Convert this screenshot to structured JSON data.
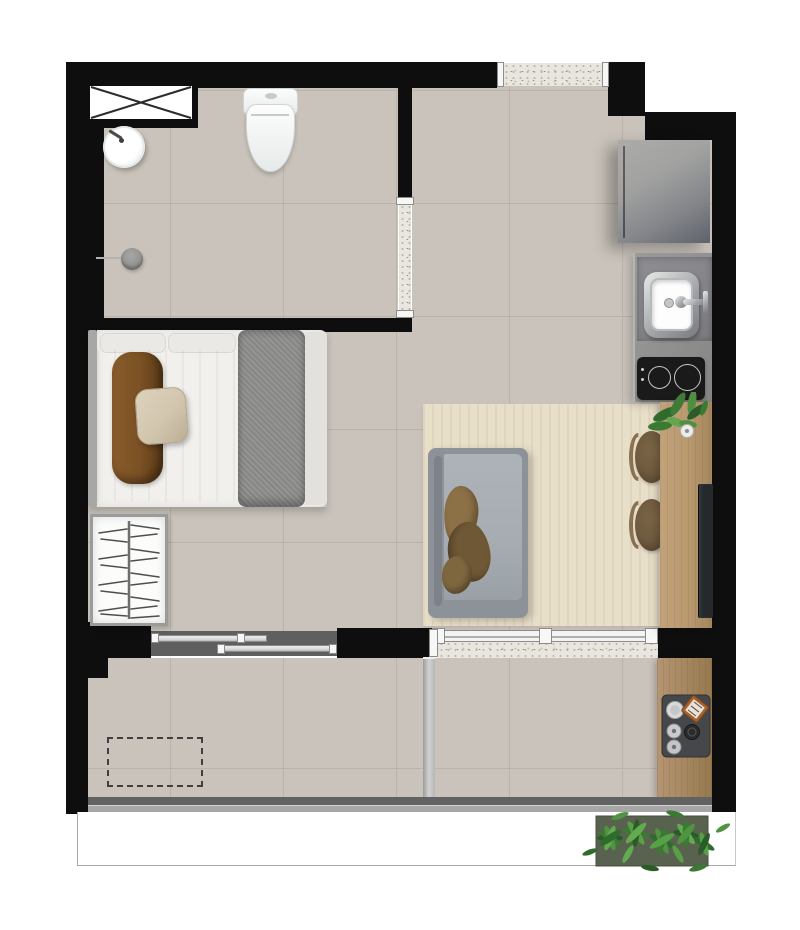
{
  "canvas": {
    "width": 800,
    "height": 930,
    "background": "#ffffff"
  },
  "scene": {
    "kind": "apartment-floor-plan",
    "style": "top-down rendered architectural plan, no text labels",
    "unit_type": "studio apartment with balcony"
  },
  "palette": {
    "white": "#ffffff",
    "wall": "#0e0e0e",
    "tile": "#c9c3bb",
    "grout": "#bab3aa",
    "granite": "#e9e6df",
    "rug": "#e8dfc9",
    "wood": "#b9986e",
    "woodDark": "#a5875f",
    "sofa": "#a6acb2",
    "sofaFrame": "#8c9297",
    "throw": "#8d7146",
    "throwDark": "#6f5835",
    "chair": "#6e5a3e",
    "chairBack": "#8a7152",
    "sheet": "#f1f0ed",
    "bedBlanket": "#8e8e8c",
    "headboard": "#a7a7a5",
    "pillowBrown": "#7a5124",
    "pillowBeige": "#d2c6af",
    "counter": "#90908e",
    "counterDark": "#85858a",
    "cooktop": "#1a1a1a",
    "fridgeA": "#a2a3a1",
    "fridgeB": "#5f626a",
    "tv": "#26292c",
    "glass": "#5f5f5f",
    "glassBar": "#dcdcdc",
    "plant": "#3f7a38",
    "planter": "#59624f",
    "parapetA": "#626262",
    "parapetB": "#a6a6a6",
    "partition": "#b5b5b5",
    "copper": "#a5622c"
  },
  "rooms": [
    {
      "id": "bathroom",
      "items": [
        "ventilation-shaft-x-box",
        "toilet",
        "round-washbasin",
        "wall-mounted-faucet",
        "shower-floor-drain",
        "granite-door-threshold"
      ]
    },
    {
      "id": "entry-kitchen",
      "items": [
        "granite-entry-threshold",
        "refrigerator",
        "concrete-counter",
        "square-undermount-sink",
        "kitchen-faucet",
        "two-burner-cooktop"
      ]
    },
    {
      "id": "studio-bedroom",
      "items": [
        "double-bed",
        "headboard",
        "white-pillows",
        "brown-bolster-pillow",
        "beige-accent-pillow",
        "gray-bed-runner",
        "open-wardrobe-with-hangers",
        "sliding-window-to-balcony"
      ]
    },
    {
      "id": "living-dining",
      "items": [
        "light-wood-rug",
        "gray-sofa",
        "brown-throw-blanket",
        "dining-console-table",
        "round-chair",
        "round-chair",
        "potted-plant",
        "wall-mounted-tv",
        "sliding-glass-door"
      ]
    },
    {
      "id": "balcony",
      "items": [
        "glass-partition",
        "dashed-future-furniture-outline",
        "wood-grill-counter",
        "barbecue-grill-set",
        "parapet-rail",
        "outdoor-planter-with-ferns"
      ]
    }
  ]
}
